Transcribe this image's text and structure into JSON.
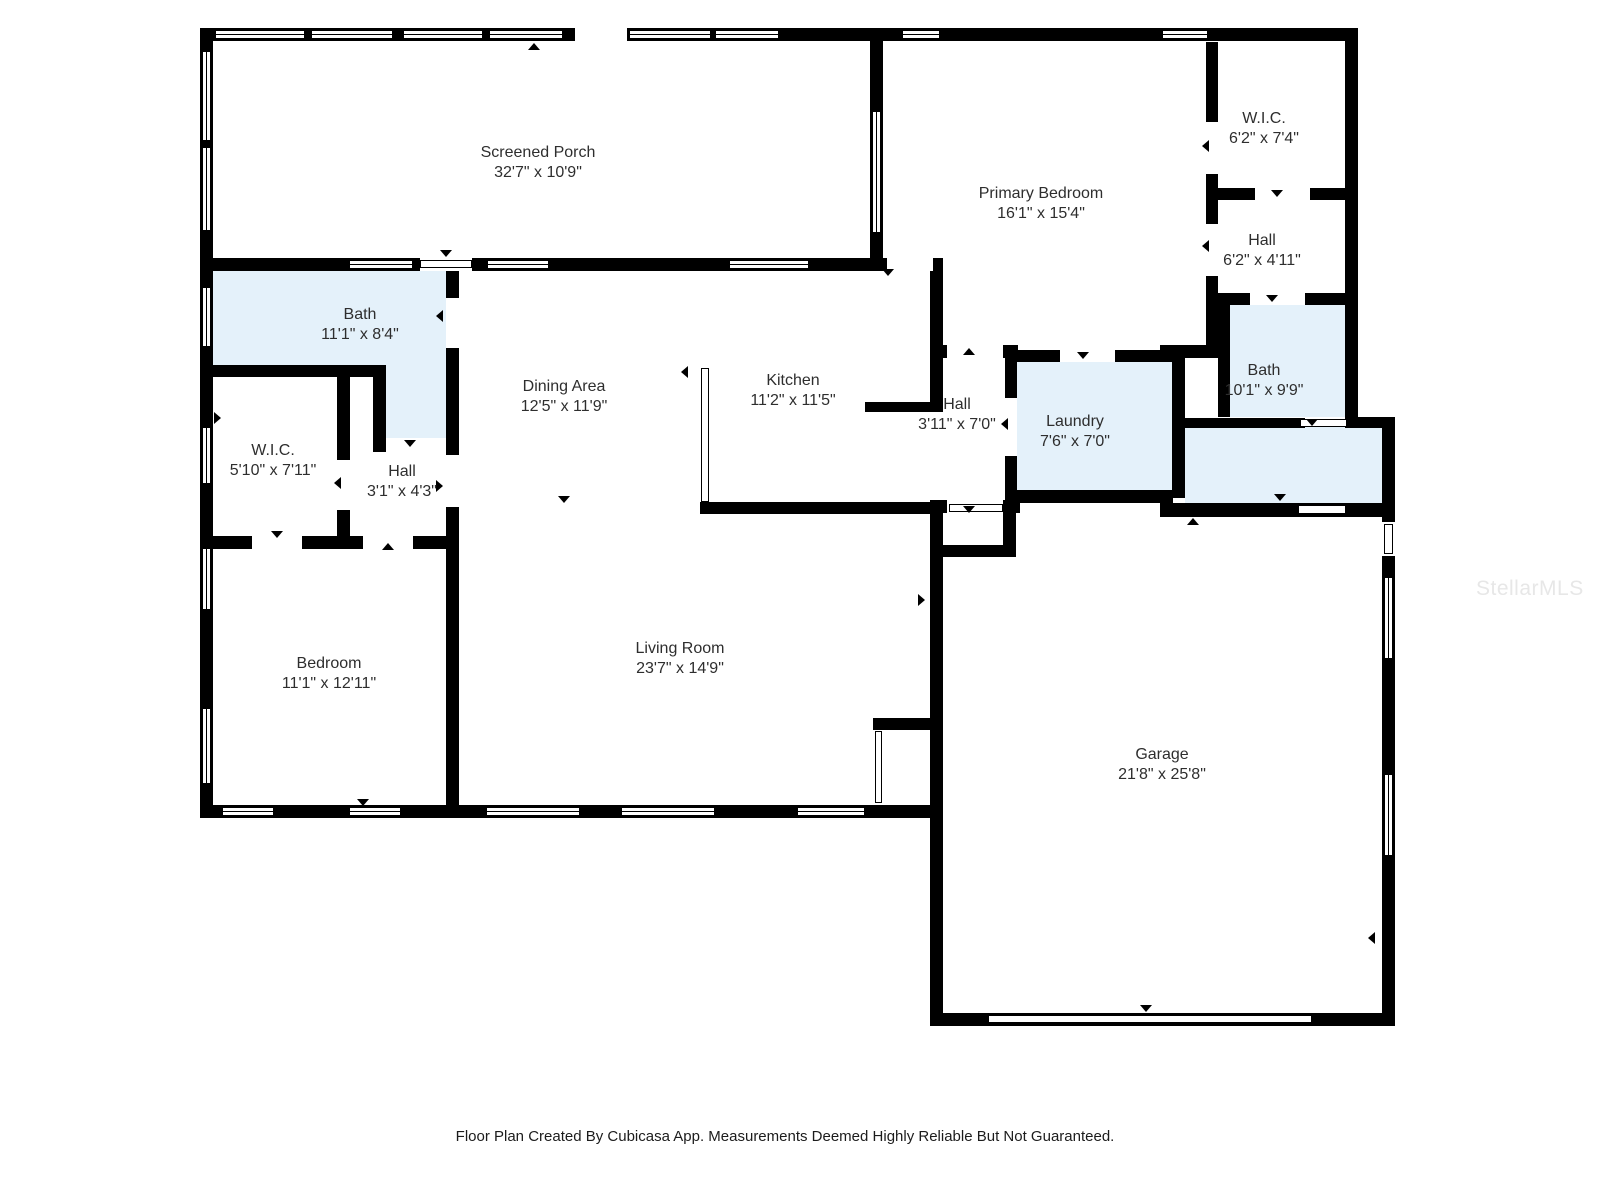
{
  "footer": "Floor Plan Created By Cubicasa App. Measurements Deemed Highly Reliable But Not Guaranteed.",
  "watermark": "StellarMLS",
  "colors": {
    "wall": "#000000",
    "wet_room_fill": "#e4f1fa",
    "floor_fill": "#ffffff",
    "label_text": "#2e2e2e",
    "footer_text": "#1c1c1c",
    "watermark_text": "#e7e7e7"
  },
  "rooms": [
    {
      "id": "screened-porch",
      "name": "Screened Porch",
      "dims": "32'7\" x 10'9\""
    },
    {
      "id": "primary-bedroom",
      "name": "Primary Bedroom",
      "dims": "16'1\" x 15'4\""
    },
    {
      "id": "wic-right",
      "name": "W.I.C.",
      "dims": "6'2\" x 7'4\""
    },
    {
      "id": "hall-right",
      "name": "Hall",
      "dims": "6'2\" x 4'11\""
    },
    {
      "id": "bath-right",
      "name": "Bath",
      "dims": "10'1\" x 9'9\""
    },
    {
      "id": "bath-left",
      "name": "Bath",
      "dims": "11'1\" x 8'4\""
    },
    {
      "id": "dining-area",
      "name": "Dining Area",
      "dims": "12'5\" x 11'9\""
    },
    {
      "id": "kitchen",
      "name": "Kitchen",
      "dims": "11'2\" x 11'5\""
    },
    {
      "id": "hall-mid",
      "name": "Hall",
      "dims": "3'11\" x 7'0\""
    },
    {
      "id": "laundry",
      "name": "Laundry",
      "dims": "7'6\" x 7'0\""
    },
    {
      "id": "wic-left",
      "name": "W.I.C.",
      "dims": "5'10\" x 7'11\""
    },
    {
      "id": "hall-left",
      "name": "Hall",
      "dims": "3'1\" x 4'3\""
    },
    {
      "id": "bedroom",
      "name": "Bedroom",
      "dims": "11'1\" x 12'11\""
    },
    {
      "id": "living-room",
      "name": "Living Room",
      "dims": "23'7\" x 14'9\""
    },
    {
      "id": "garage",
      "name": "Garage",
      "dims": "21'8\" x 25'8\""
    }
  ]
}
